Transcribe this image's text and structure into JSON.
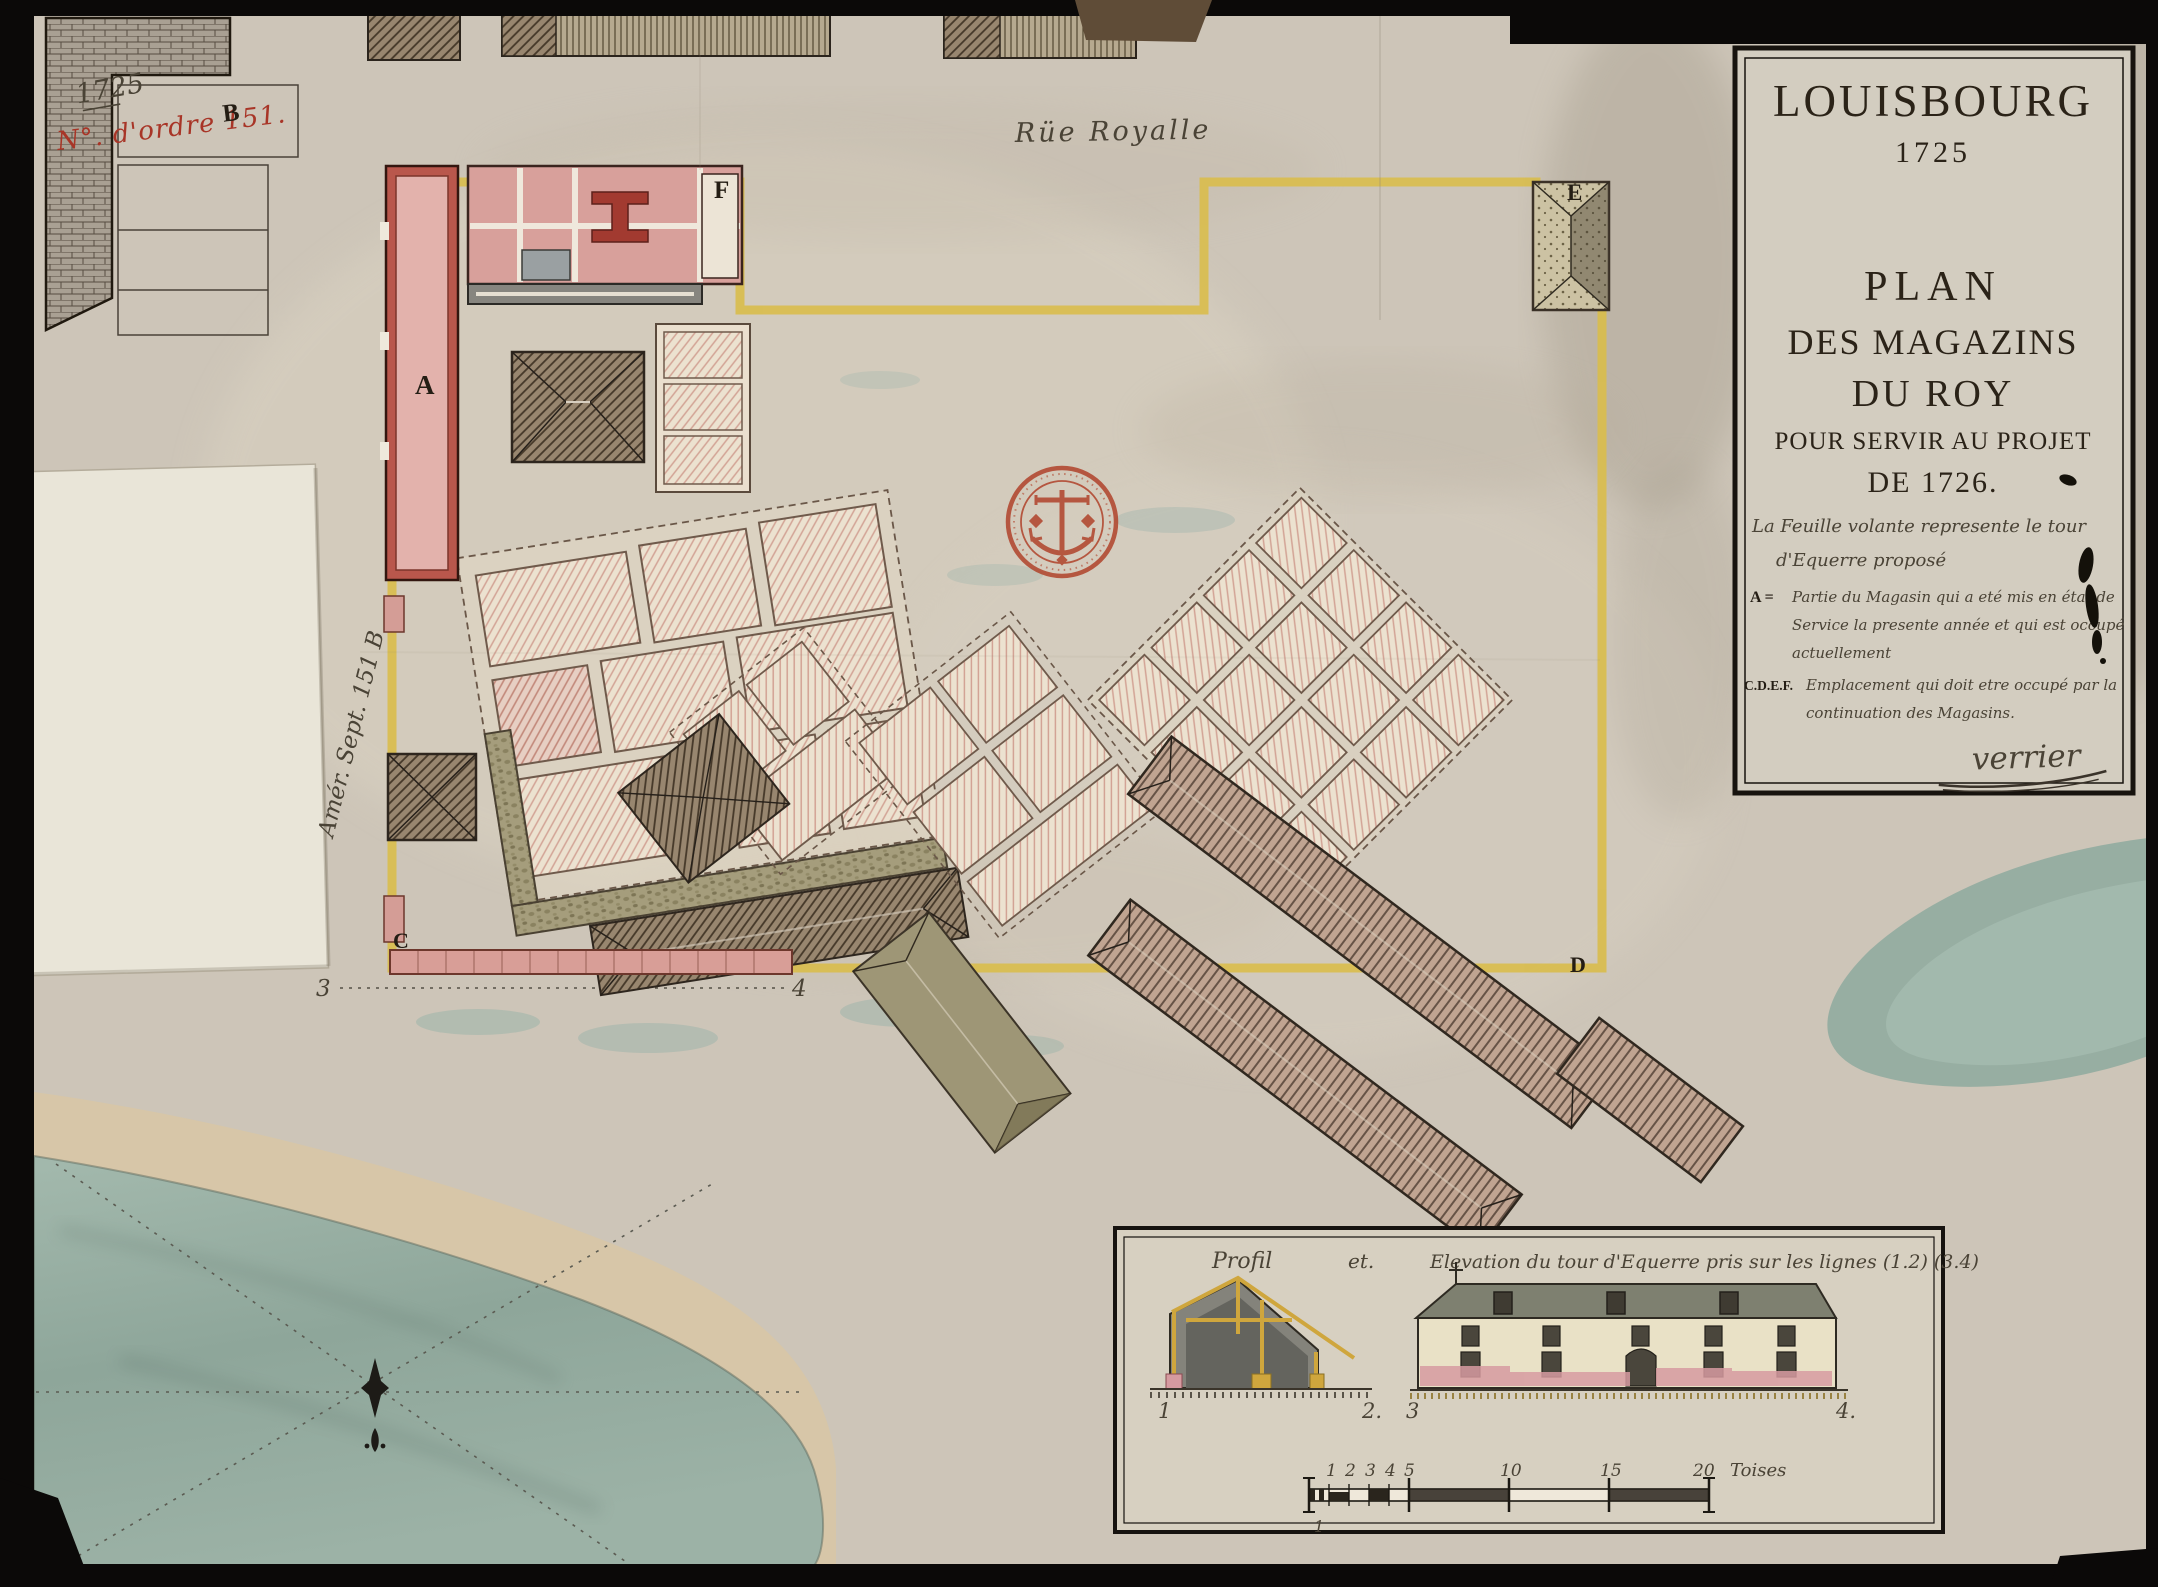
{
  "annotations": {
    "year_note": "1725",
    "order_number": "N°. d'ordre 151.",
    "order_letter": "B",
    "margin_note": "Amér. Sept. 151 B"
  },
  "map": {
    "street_label": "Rüe Royalle",
    "label_a": "A",
    "label_c": "C",
    "label_d": "D",
    "label_e": "E",
    "label_f": "F",
    "section_marker_3": "3",
    "section_marker_4": "4"
  },
  "cartouche": {
    "place": "LOUISBOURG",
    "year": "1725",
    "title_1": "PLAN",
    "title_2": "DES MAGAZINS",
    "title_3": "DU ROY",
    "title_4": "POUR SERVIR AU PROJET",
    "title_5": "DE 1726.",
    "note_1": "La Feuille volante represente le tour",
    "note_2": "d'Equerre proposé",
    "legend_a_key": "A =",
    "legend_a_1": "Partie du Magasin qui a eté mis en état de",
    "legend_a_2": "Service la presente année et qui est occupé",
    "legend_a_3": "actuellement",
    "legend_cdef_key": "C.D.E.F.",
    "legend_cdef_1": "Emplacement qui doit etre occupé par la",
    "legend_cdef_2": "continuation des Magasins.",
    "signature": "verrier"
  },
  "inset": {
    "caption_profil": "Profil",
    "caption_et": "et.",
    "caption_elevation": "Elevation du tour d'Equerre pris sur les lignes (1.2) (3.4)",
    "marker_1": "1",
    "marker_2": "2.",
    "marker_3": "3",
    "marker_4": "4.",
    "scale": {
      "t1": "1",
      "t2": "2",
      "t3": "3",
      "t4": "4",
      "t5": "5",
      "t10": "10",
      "t15": "15",
      "t20": "20",
      "unit": "Toises",
      "sub": "1"
    }
  },
  "colors": {
    "boundary_yellow": "#d9bd4e",
    "building_pink": "#e0a9a2",
    "stamp_red": "#b1472f",
    "water_teal": "#93aca2",
    "paper": "#cdc5b8"
  }
}
